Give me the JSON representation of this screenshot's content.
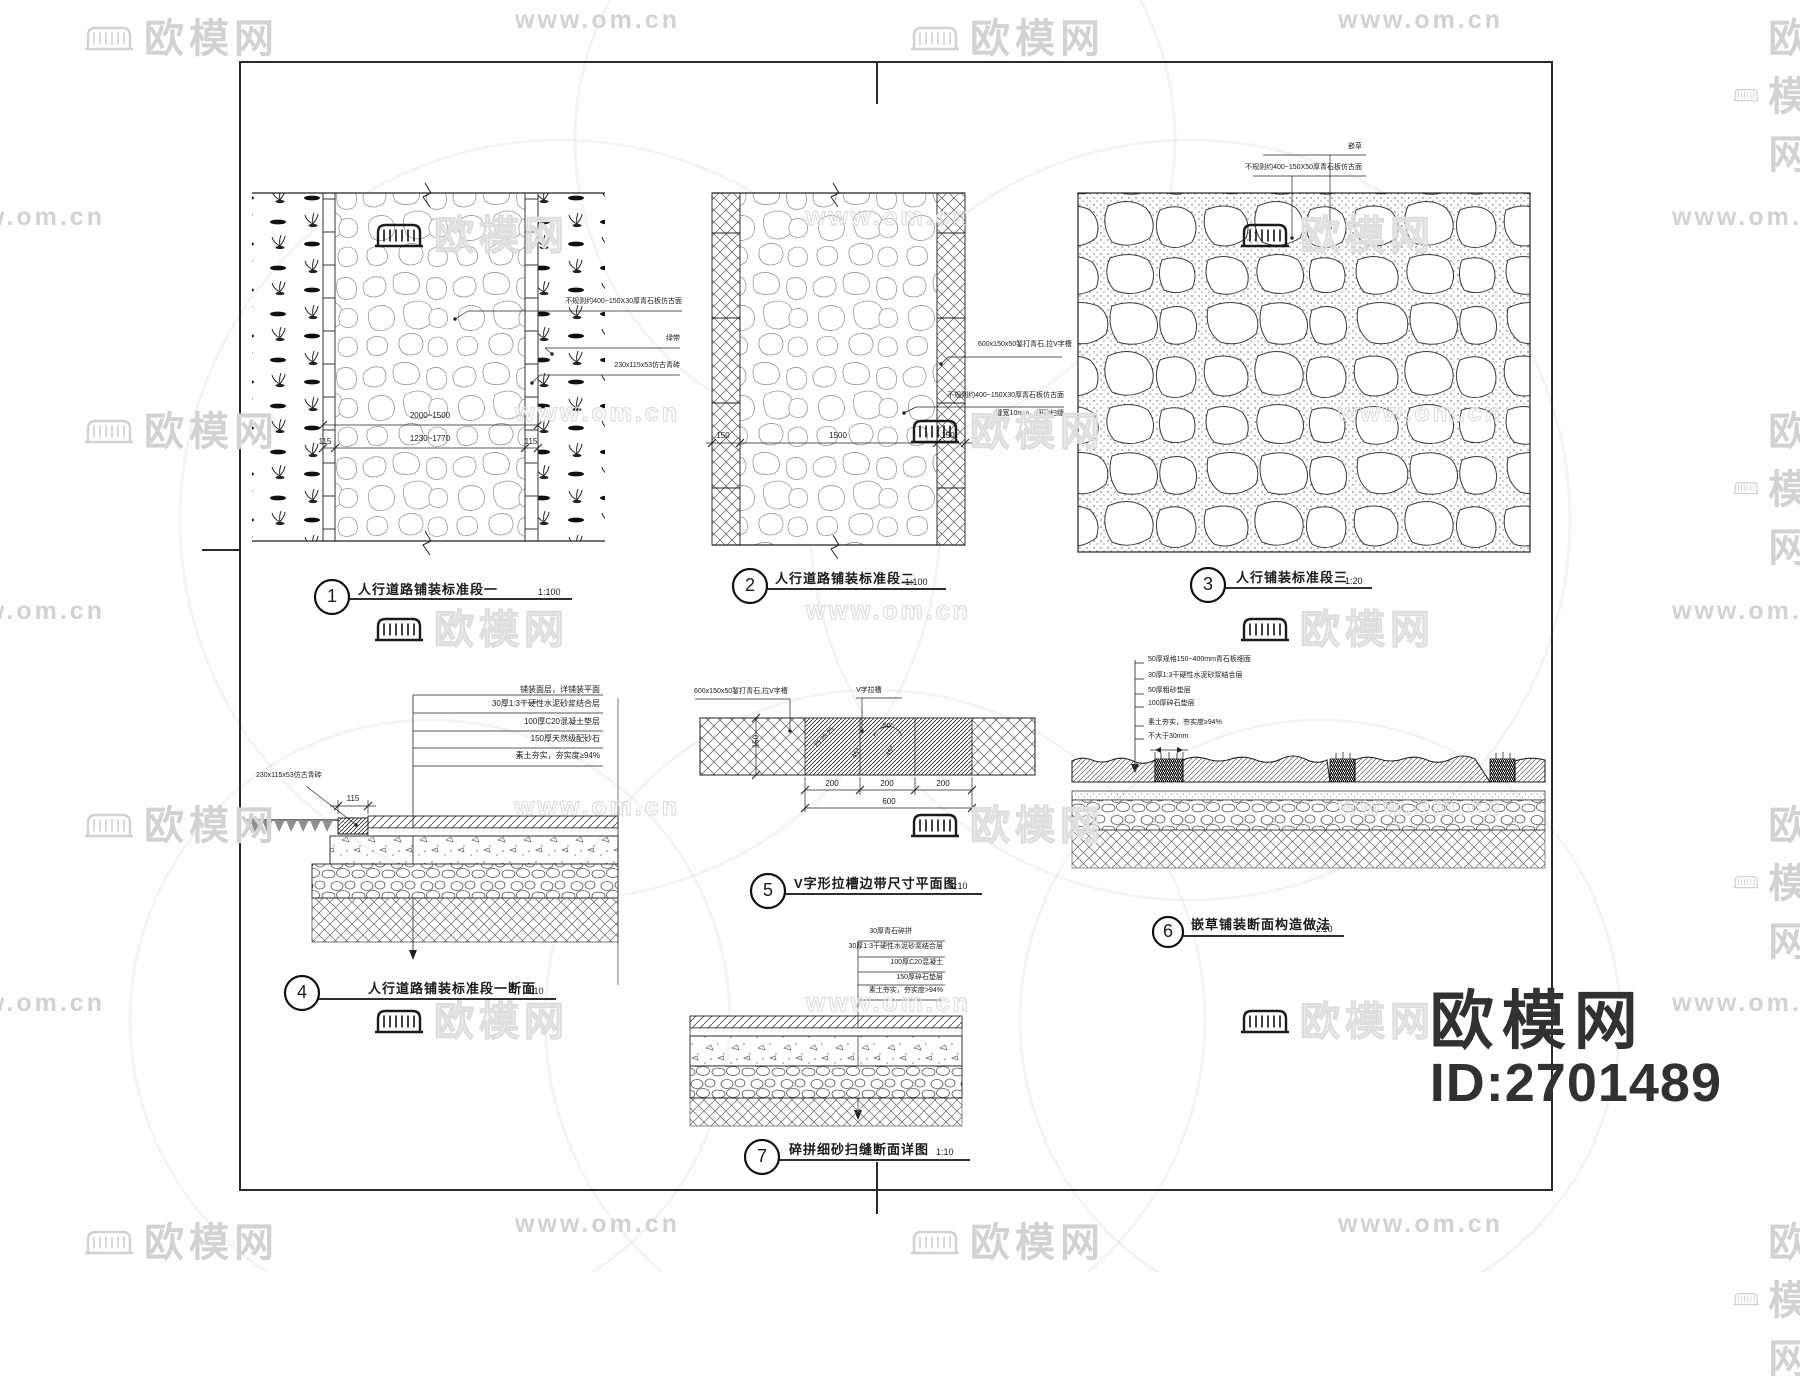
{
  "watermark": {
    "brand": "欧模网",
    "url": "www.om.cn",
    "site_id": "ID:2701489"
  },
  "titles": {
    "d1": {
      "num": "1",
      "label": "人行道路铺装标准段一",
      "scale": "1:100"
    },
    "d2": {
      "num": "2",
      "label": "人行道路铺装标准段二",
      "scale": "1:100"
    },
    "d3": {
      "num": "3",
      "label": "人行铺装标准段三",
      "scale": "1:20"
    },
    "d4": {
      "num": "4",
      "label": "人行道路铺装标准段一断面",
      "scale": "1:10"
    },
    "d5": {
      "num": "5",
      "label": "V字形拉槽边带尺寸平面图",
      "scale": "1:10"
    },
    "d6": {
      "num": "6",
      "label": "嵌草铺装断面构造做法",
      "scale": "1:10"
    },
    "d7": {
      "num": "7",
      "label": "碎拼细砂扫缝断面详图",
      "scale": "1:10"
    }
  },
  "d1": {
    "ann1": "不规则约400~150X30厚青石板仿古面",
    "ann2": "绿带",
    "ann3": "230x115x53仿古青砖",
    "dim_outer": "2000~1500",
    "dim_inner": "1230~1770",
    "dim_edge": "115"
  },
  "d2": {
    "ann1": "600x150x50錾打青石,拉V字槽",
    "ann2_line1": "不规则约400~150X30厚青石板仿古面",
    "ann2_line2": "缝宽10mm，细砂扫缝",
    "dim_side": "150",
    "dim_mid": "1500"
  },
  "d3": {
    "ann_grass": "嵌草",
    "ann_stone": "不规则约400~150X50厚青石板仿古面"
  },
  "d4": {
    "header": "铺装面层，详铺装平面",
    "layers": [
      "30厚1:3干硬性水泥砂浆结合层",
      "100厚C20混凝土垫层",
      "150厚天然级配砂石",
      "素土夯实，夯实度≥94%"
    ],
    "brick_note": "230x115x53仿古青砖",
    "brick_dim": "115"
  },
  "d5": {
    "ann_left": "600x150x50錾打青石,拉V字槽",
    "ann_right": "V字拉槽",
    "height_dim": "150",
    "seg_dim": "200",
    "total_dim": "600",
    "angle_top": "50°",
    "angle_left": "45°",
    "angle_right": "45°",
    "groove_dims": "25 25 25"
  },
  "d6": {
    "layers": [
      "50厚规格150~400mm青石板细面",
      "30厚1:3干硬性水泥砂浆结合层",
      "50厚粗砂垫层",
      "100厚碎石垫层",
      "素土夯实，夯实度≥94%"
    ],
    "gap_note": "不大于30mm"
  },
  "d7": {
    "header": "30厚青石碎拼",
    "layers": [
      "30厚1:3干硬性水泥砂浆结合层",
      "100厚C20混凝土",
      "150厚碎石垫层",
      "素土夯实，夯实度>94%"
    ]
  }
}
